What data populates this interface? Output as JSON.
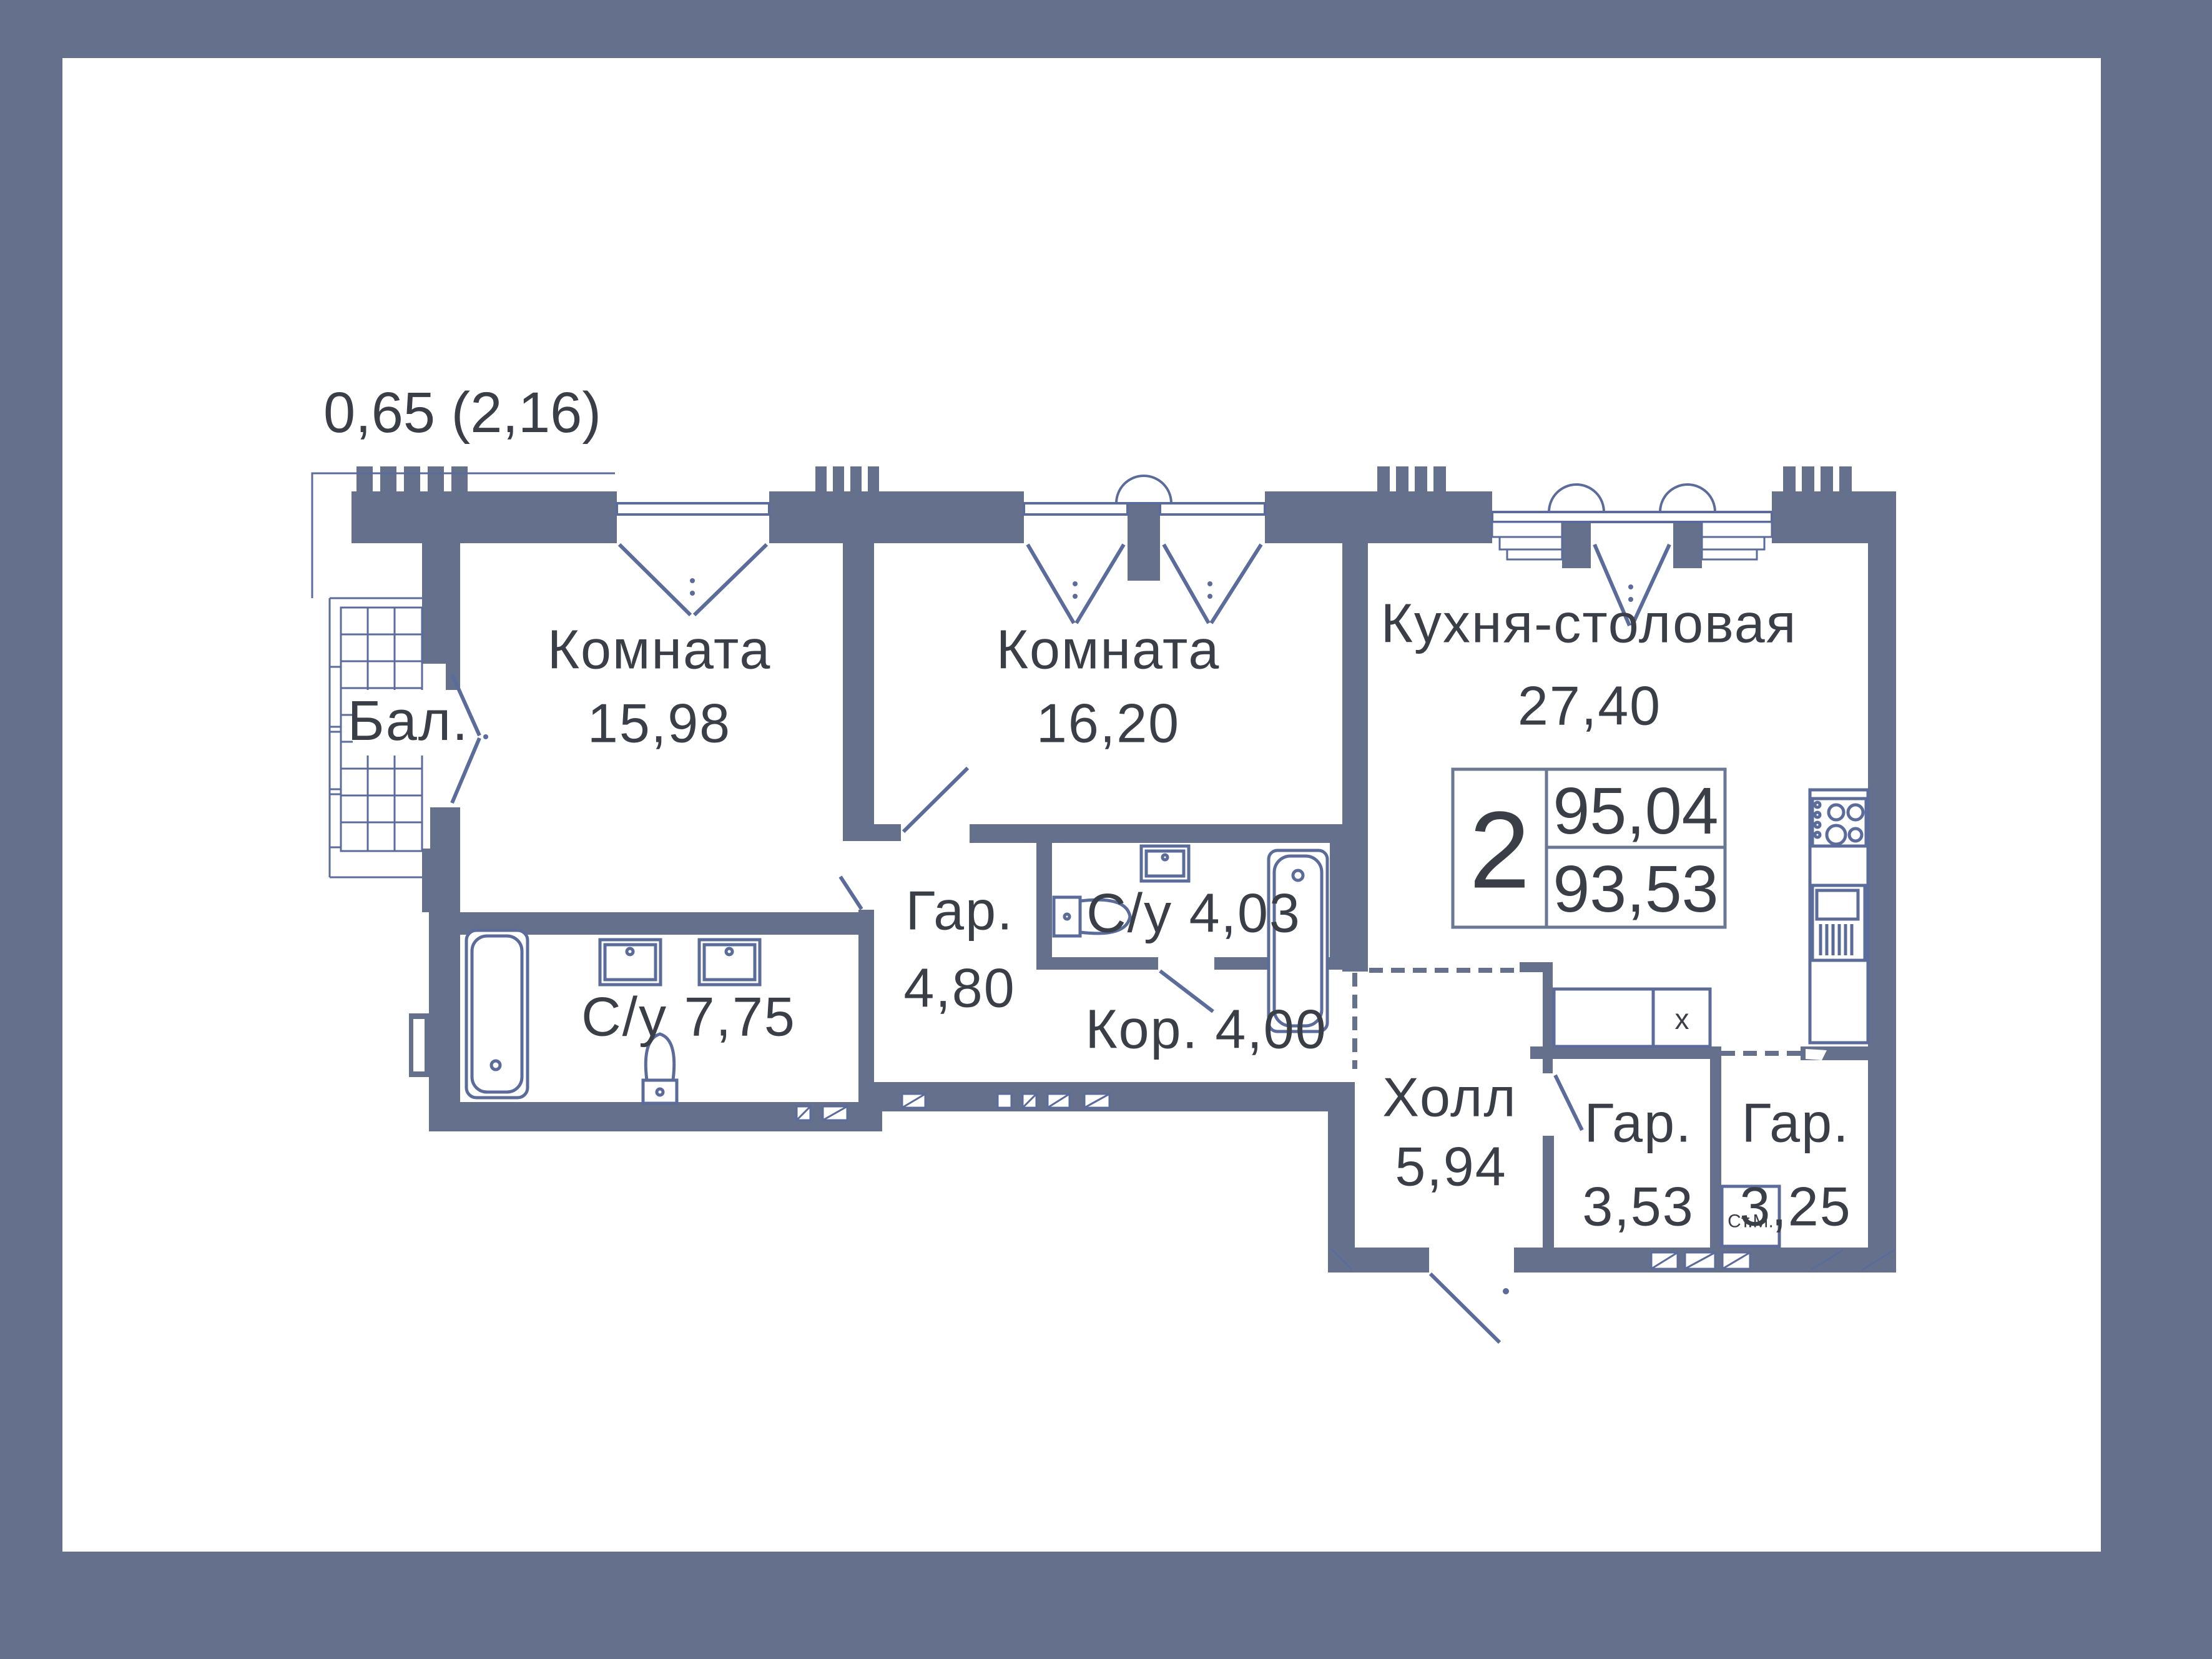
{
  "annotation": {
    "balcony_coef_area": "0,65 (2,16)"
  },
  "plan": {
    "balcony": "Бал.",
    "room1_name": "Комната",
    "room1_area": "15,98",
    "room2_name": "Комната",
    "room2_area": "16,20",
    "kitchen_name": "Кухня-столовая",
    "kitchen_area": "27,40",
    "bath_large": "С/у 7,75",
    "bath_small": "С/у 4,03",
    "wardrobe1_name": "Гар.",
    "wardrobe1_area": "4,80",
    "corridor": "Кор. 4,00",
    "hall_name": "Холл",
    "hall_area": "5,94",
    "wardrobe2_name": "Гар.",
    "wardrobe2_area": "3,53",
    "wardrobe3_name": "Гар.",
    "wardrobe3_area": "3,25",
    "washing_machine": "Ст.М.",
    "closet_marker": "x"
  },
  "stat": {
    "rooms_count": "2",
    "total_area": "95,04",
    "living_area": "93,53"
  },
  "colors": {
    "wall": "#65718C",
    "line": "#5B6C9B",
    "text": "#3A3E46",
    "bg": "#FFFFFF",
    "frame": "#65718C"
  }
}
